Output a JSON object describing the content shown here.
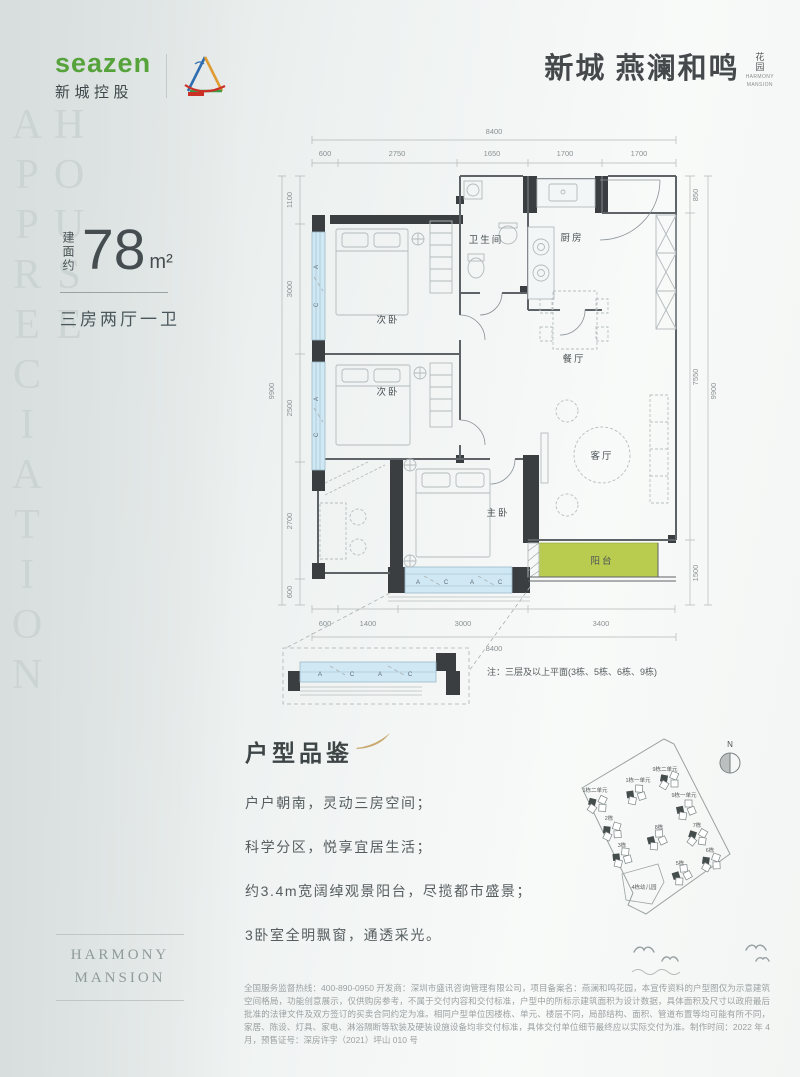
{
  "brand": {
    "logo_text": "seazen",
    "logo_cn": "新城控股",
    "title": "新城 燕澜和鸣",
    "title_suffix": "花园",
    "title_en_1": "HARMONY",
    "title_en_2": "MANSION"
  },
  "sidebar": {
    "vertical_text": "HOUSE APPRECIATION"
  },
  "unit": {
    "area_label": "建面约",
    "area_value": "78",
    "area_unit": "m²",
    "layout": "三房两厅一卫"
  },
  "plan": {
    "dims_top": {
      "overall": "8400",
      "segments": [
        "600",
        "2750",
        "1650",
        "1700",
        "1700"
      ]
    },
    "dims_bottom": {
      "overall": "8400",
      "segments": [
        "600",
        "1400",
        "3000",
        "3400"
      ]
    },
    "dims_left": {
      "overall": "9900",
      "segments": [
        "1100",
        "3000",
        "2500",
        "2700",
        "600"
      ]
    },
    "dims_right": {
      "overall": "9900",
      "segments": [
        "850",
        "7550",
        "1500"
      ]
    },
    "rooms": {
      "bedroom_a": "次卧",
      "bedroom_b": "次卧",
      "bathroom": "卫生间",
      "kitchen": "厨房",
      "dining": "餐厅",
      "living": "客厅",
      "master": "主卧",
      "balcony": "阳台"
    },
    "window_marks": [
      "A",
      "C"
    ],
    "bay_marks": [
      "A",
      "C",
      "A",
      "C"
    ],
    "detail": {
      "marks": [
        "A",
        "C",
        "A",
        "C"
      ],
      "note": "注：三层及以上平面(3栋、5栋、6栋、9栋)"
    }
  },
  "appreciation": {
    "title": "户型品鉴",
    "lines": [
      "户户朝南，灵动三房空间；",
      "科学分区，悦享宜居生活；",
      "约3.4m宽阔绰观景阳台，尽揽都市盛景；",
      "3卧室全明飘窗，通透采光。"
    ]
  },
  "site": {
    "compass": "N",
    "buildings": [
      {
        "label": "9栋二单元"
      },
      {
        "label": "1栋一单元"
      },
      {
        "label": "1栋二单元"
      },
      {
        "label": "9栋一单元"
      },
      {
        "label": "2栋"
      },
      {
        "label": "8栋"
      },
      {
        "label": "7栋"
      },
      {
        "label": "3栋"
      },
      {
        "label": "6栋"
      },
      {
        "label": "5栋"
      },
      {
        "label": "4栋幼儿园"
      }
    ]
  },
  "footer": {
    "logo_line1": "HARMONY",
    "logo_line2": "MANSION"
  },
  "legal": {
    "text": "全国服务监督热线：400-890-0950 开发商：深圳市盛讯咨询管理有限公司，项目备案名：燕澜和鸣花园，本宣传资料的户型图仅为示意建筑空间格局，功能创意展示，仅供购房参考，不属于交付内容和交付标准，户型中的所标示建筑面积为设计数据，具体面积及尺寸以政府最后批准的法律文件及双方签订的买卖合同约定为准。相同户型单位因楼栋、单元、楼层不同，局部结构、面积、管道布置等均可能有所不同，家居、陈设、灯具、家电、淋浴隔断等软装及硬装设施设备均非交付标准，具体交付单位细节最终应以实际交付为准。制作时间：2022 年 4 月，预售证号：深房许字（2021）坪山 010 号"
  }
}
